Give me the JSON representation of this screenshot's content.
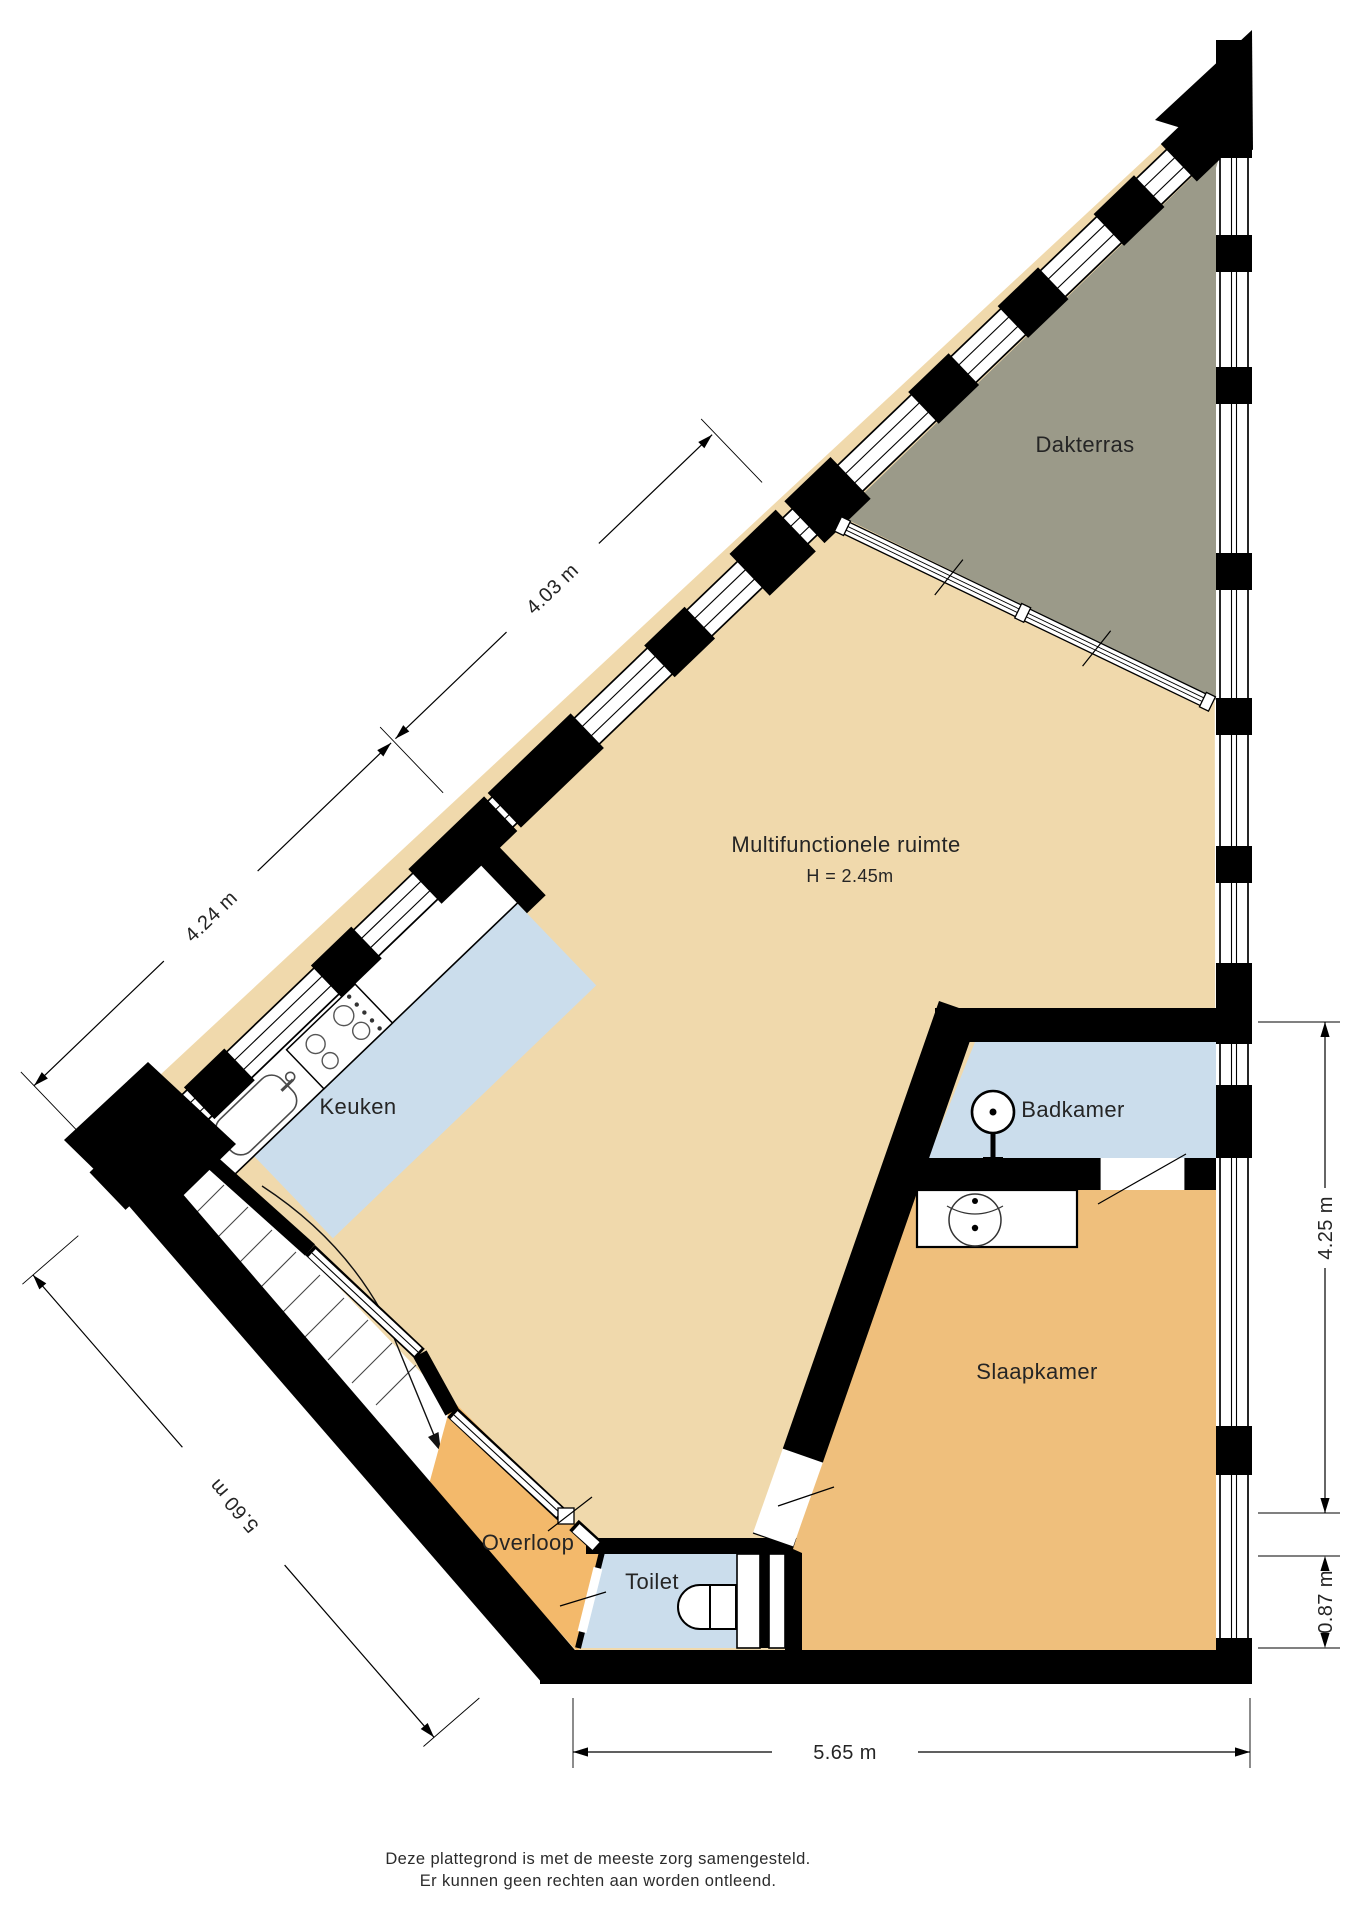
{
  "plan": {
    "rooms": {
      "dakterras": {
        "label": "Dakterras"
      },
      "multifunctionele_ruimte": {
        "label": "Multifunctionele ruimte",
        "height": "H = 2.45m"
      },
      "keuken": {
        "label": "Keuken"
      },
      "badkamer": {
        "label": "Badkamer"
      },
      "slaapkamer": {
        "label": "Slaapkamer"
      },
      "overloop": {
        "label": "Overloop"
      },
      "toilet": {
        "label": "Toilet"
      }
    },
    "dimensions": {
      "upper_left_wall_a": "4.03 m",
      "upper_left_wall_b": "4.24 m",
      "lower_left_wall": "5.60 m",
      "right_wall": "4.25 m",
      "right_wall_lower": "0.87 m",
      "bottom_wall": "5.65 m"
    },
    "colors": {
      "terrace": "#9B9A89",
      "living": "#F0D9AC",
      "kitchen": "#CBDDEC",
      "bathroom": "#CBDDEC",
      "toilet": "#CBDDEC",
      "bedroom": "#EFBF7C",
      "landing": "#F3B96B",
      "wall": "#000000"
    },
    "footer": {
      "line1": "Deze plattegrond is met de meeste zorg samengesteld.",
      "line2": "Er kunnen geen rechten aan worden ontleend."
    }
  }
}
